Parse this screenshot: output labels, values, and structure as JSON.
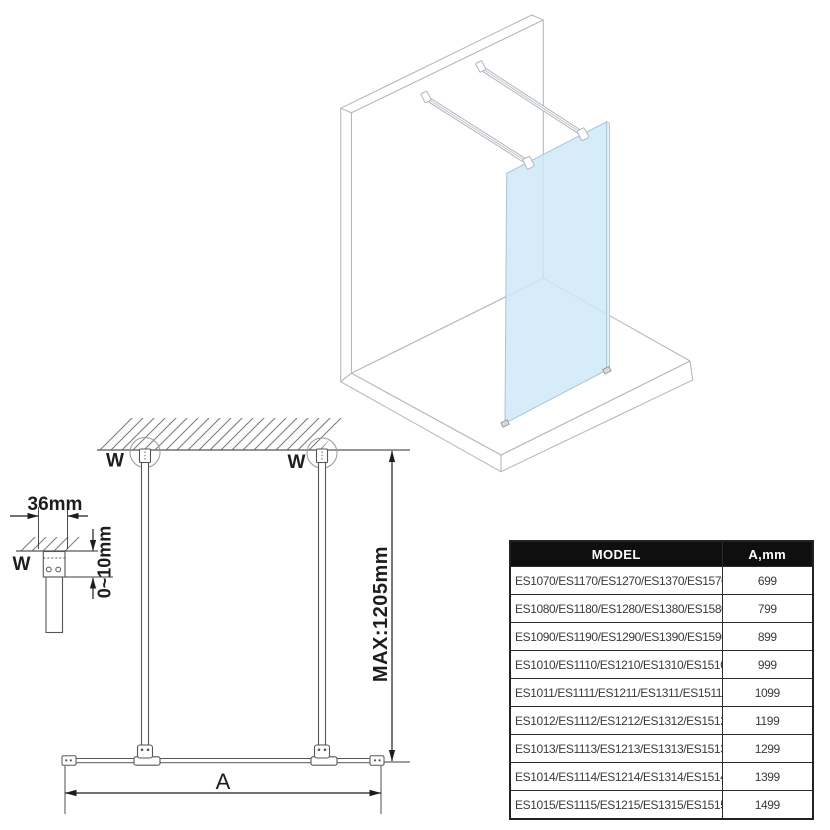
{
  "labels": {
    "wall_marker": "W",
    "dim_width_36mm": "36mm",
    "dim_gap_0_10mm": "0~10mm",
    "dim_max_height": "MAX:1205mm",
    "dim_glass_width": "A"
  },
  "colors": {
    "glass_fill": "#cde8f8",
    "glass_edge_fill": "#e2f0fa",
    "glass_stroke": "#a8c4d6",
    "outline_3d": "#b2b8bf",
    "outline_2d": "#565656",
    "dimension": "#1d1d1d",
    "hatch": "#7f7f7f",
    "table_border": "#2b2b2b",
    "table_header_bg": "#0f0f0f",
    "table_header_text": "#ffffff",
    "table_text": "#3a3a3a"
  },
  "spec_table": {
    "headers": {
      "model": "MODEL",
      "width": "A,mm"
    },
    "rows": [
      {
        "model": "ES1070/ES1170/ES1270/ES1370/ES1570",
        "a_mm": "699"
      },
      {
        "model": "ES1080/ES1180/ES1280/ES1380/ES1580",
        "a_mm": "799"
      },
      {
        "model": "ES1090/ES1190/ES1290/ES1390/ES1590",
        "a_mm": "899"
      },
      {
        "model": "ES1010/ES1110/ES1210/ES1310/ES1510",
        "a_mm": "999"
      },
      {
        "model": "ES1011/ES1111/ES1211/ES1311/ES1511",
        "a_mm": "1099"
      },
      {
        "model": "ES1012/ES1112/ES1212/ES1312/ES1512",
        "a_mm": "1199"
      },
      {
        "model": "ES1013/ES1113/ES1213/ES1313/ES1513",
        "a_mm": "1299"
      },
      {
        "model": "ES1014/ES1114/ES1214/ES1314/ES1514",
        "a_mm": "1399"
      },
      {
        "model": "ES1015/ES1115/ES1215/ES1315/ES1515",
        "a_mm": "1499"
      }
    ]
  }
}
